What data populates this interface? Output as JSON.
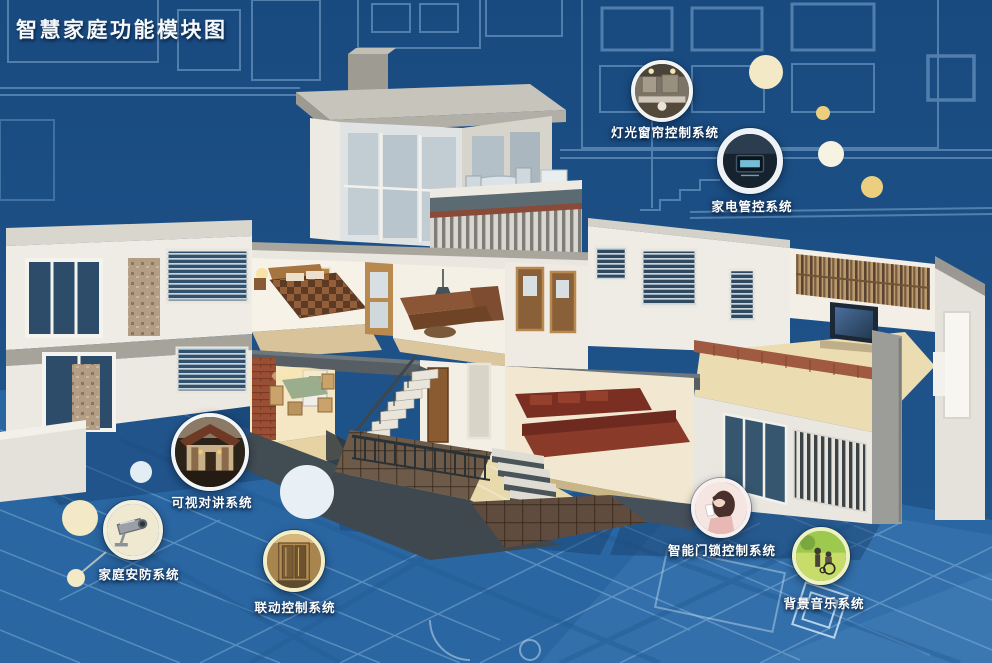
{
  "title": "智慧家庭功能模块图",
  "modules": [
    {
      "name": "lighting-curtain-control",
      "label": "灯光窗帘控制系统",
      "photo": "kitchen-downlights-photo"
    },
    {
      "name": "appliance-control",
      "label": "家电管控系统",
      "photo": "control-panel-screen-photo"
    },
    {
      "name": "video-intercom",
      "label": "可视对讲系统",
      "photo": "house-entrance-photo"
    },
    {
      "name": "home-security",
      "label": "家庭安防系统",
      "photo": "cctv-camera-photo"
    },
    {
      "name": "linkage-control",
      "label": "联动控制系统",
      "photo": "elevator-doors-photo"
    },
    {
      "name": "smart-door-lock-control",
      "label": "智能门锁控制系统",
      "photo": "woman-with-phone-photo"
    },
    {
      "name": "background-music",
      "label": "背景音乐系统",
      "photo": "garden-wheelchair-photo"
    }
  ],
  "colors": {
    "blueprint_background": "#1c4d83",
    "blueprint_floor": "#2a66a2",
    "blueprint_line": "#7fa9d2",
    "badge_ring": "#ffffff",
    "accent_cream": "#f3e9c6",
    "accent_gold": "#eccf7e",
    "label_text": "#ffffff"
  }
}
